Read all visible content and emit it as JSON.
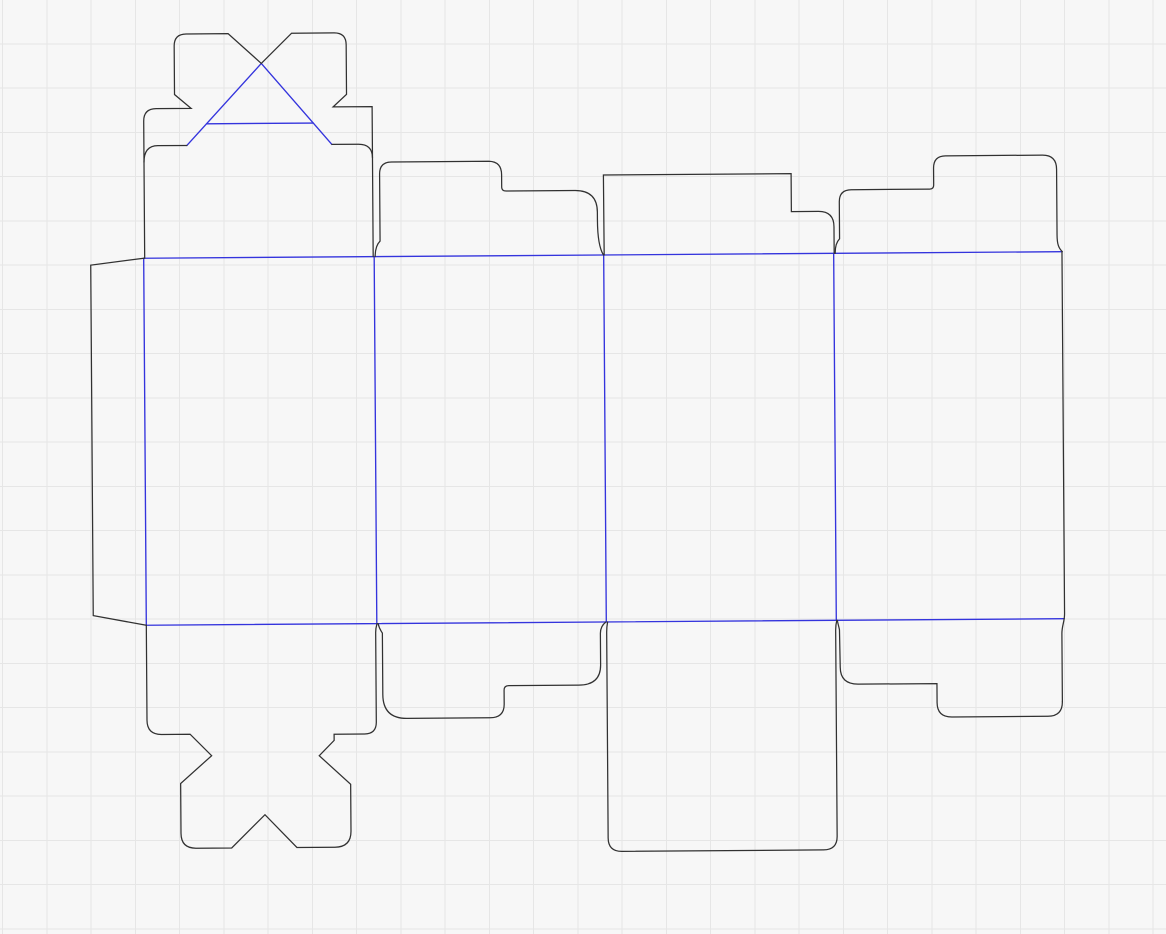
{
  "canvas": {
    "width": 1166,
    "height": 934,
    "background": "#f7f7f7",
    "grid": {
      "spacing": 44.25,
      "offset_x": 2.5,
      "offset_y": -0.5,
      "color": "#e6e6e6",
      "stroke_width": 1
    }
  },
  "dieline": {
    "rotation": {
      "angle_deg": -0.41,
      "cx": 600,
      "cy": 440
    },
    "styles": {
      "cut": {
        "color": "#313131",
        "width": 1.25
      },
      "fold": {
        "color": "#3434dd",
        "width": 1.35
      }
    },
    "fold_paths": [
      {
        "name": "fold-top-horizontal",
        "d": "M 145,255 L 1063,255"
      },
      {
        "name": "fold-bottom-horizontal",
        "d": "M 145,622 L 1063,622"
      },
      {
        "name": "fold-vertical-glue",
        "d": "M 145,255 L 145,622"
      },
      {
        "name": "fold-vertical-panel-1-2",
        "d": "M 375.5,255 L 375.5,622"
      },
      {
        "name": "fold-vertical-panel-2-3",
        "d": "M 605,255 L 605,622"
      },
      {
        "name": "fold-vertical-panel-3-4",
        "d": "M 835,255 L 835,622"
      },
      {
        "name": "fold-crashlock-diagonal-left",
        "d": "M 189,142.5 L 264,61"
      },
      {
        "name": "fold-crashlock-diagonal-right",
        "d": "M 264,61 L 334,142.5"
      },
      {
        "name": "fold-crashlock-horizontal",
        "d": "M 208.8,121 L 315.5,121"
      }
    ],
    "cut_paths": [
      {
        "name": "glue-flap-outline",
        "d": "M 145,255 L 92,261.5 L 92,612 L 145,622"
      },
      {
        "name": "crashlock-top-flap-outline",
        "d": "M 146,255 L 146,118 Q 146,105.5 158.5,105.5 L 193.5,105.5 L 177,91.5 L 177,43 Q 177,31 189,31 L 231,31 L 264,61 L 294.5,31 L 337,31 Q 349,31 349,43 L 349,92.5 L 335.5,105 L 374.5,105 L 374.5,255"
      },
      {
        "name": "crashlock-slit-left",
        "d": "M 146,159 Q 146,142.5 160,142.5 L 189,142.5"
      },
      {
        "name": "crashlock-slit-right",
        "d": "M 374.5,156 Q 374.5,142.5 360.5,142.5 L 334,142.5"
      },
      {
        "name": "top-flap-panel2-outline",
        "d": "M 376.5,255 C 376.5,247.5 378,243 381.5,239.5 L 381.5,172.5 Q 381.5,160.5 393.5,160.5 L 491,160.5 Q 503.5,161 503.5,174 L 503.5,186.5 Q 503.5,190.3 508,190.3 L 577,190.3 Q 599,190.5 599,212 L 599,220 C 599,238 601,249 604.8,255"
      },
      {
        "name": "top-flap-panel3-outline",
        "d": "M 605.5,255 L 605.3,175 L 793,175 L 793,213 L 820,213 Q 835.5,213 835.5,228.5 L 835.5,255"
      },
      {
        "name": "top-flap-panel4-outline",
        "d": "M 836.5,255 C 836.5,248 838,243.5 841,240.5 L 841,203.5 Q 841,191.5 853,191.5 L 931.5,191.5 Q 935.5,191.5 935.5,187.5 L 935.5,170.5 Q 935.5,158.3 947.5,158.3 L 1044.5,158.3 Q 1058.5,158.3 1058.5,172.5 L 1058.5,238 C 1058.5,247.5 1060,251.5 1063.7,255"
      },
      {
        "name": "panel4-right-edge",
        "d": "M 1063.3,255 L 1063.3,617 C 1063.3,625 1060.5,629 1060.5,637 L 1060.5,705"
      },
      {
        "name": "bottom-flap-panel1-crashlock-outline",
        "d": "M 145,622 L 145,717 Q 145,731.3 159.5,731.3 L 188,731.3 L 209.4,752.9 L 178.2,780.5 L 178.2,830.3 Q 178.2,845.3 193.2,845.3 L 228.8,845.3 L 262.3,812.3 L 294,845.3 L 332,845.3 Q 348.2,845.3 348.2,829.3 L 348.2,782.5 L 317,753.7 L 332,738.5 L 332,732.3 L 362.5,732.3 Q 374.3,732.3 374.3,720.5 L 374.3,631 C 374.3,626.5 375,624.5 375.7,622"
      },
      {
        "name": "bottom-flap-panel2-outline",
        "d": "M 376.8,622 C 377.5,625.5 379,628.5 381,631.5 L 381,693 Q 381,717 405,717 L 488,717 Q 502.3,717 502.3,703.5 L 502.3,689.5 Q 502.3,685 507,685 L 577,685 Q 599,685 599,665 L 599,633.5 C 599,628.5 600.8,624.8 604.6,622"
      },
      {
        "name": "bottom-flap-panel3-outline",
        "d": "M 606.3,622 C 605.6,625.5 605.3,628.5 605.3,632.5 L 605.3,838 Q 605.3,851.5 619,851.5 L 820.5,851.5 Q 834.3,851.5 834.3,838 L 834.3,632 C 834.3,627.5 834.8,624.8 835.5,622"
      },
      {
        "name": "bottom-flap-panel4-outline",
        "d": "M 836,622 C 836.6,625.5 837.6,628.5 838.1,631.5 L 838.6,669 Q 838.6,686 856.5,686 L 935.2,686 L 935.2,705 Q 935.2,719.5 950,719.5 L 1046,719.5 Q 1060.5,719.5 1060.5,705"
      }
    ]
  }
}
